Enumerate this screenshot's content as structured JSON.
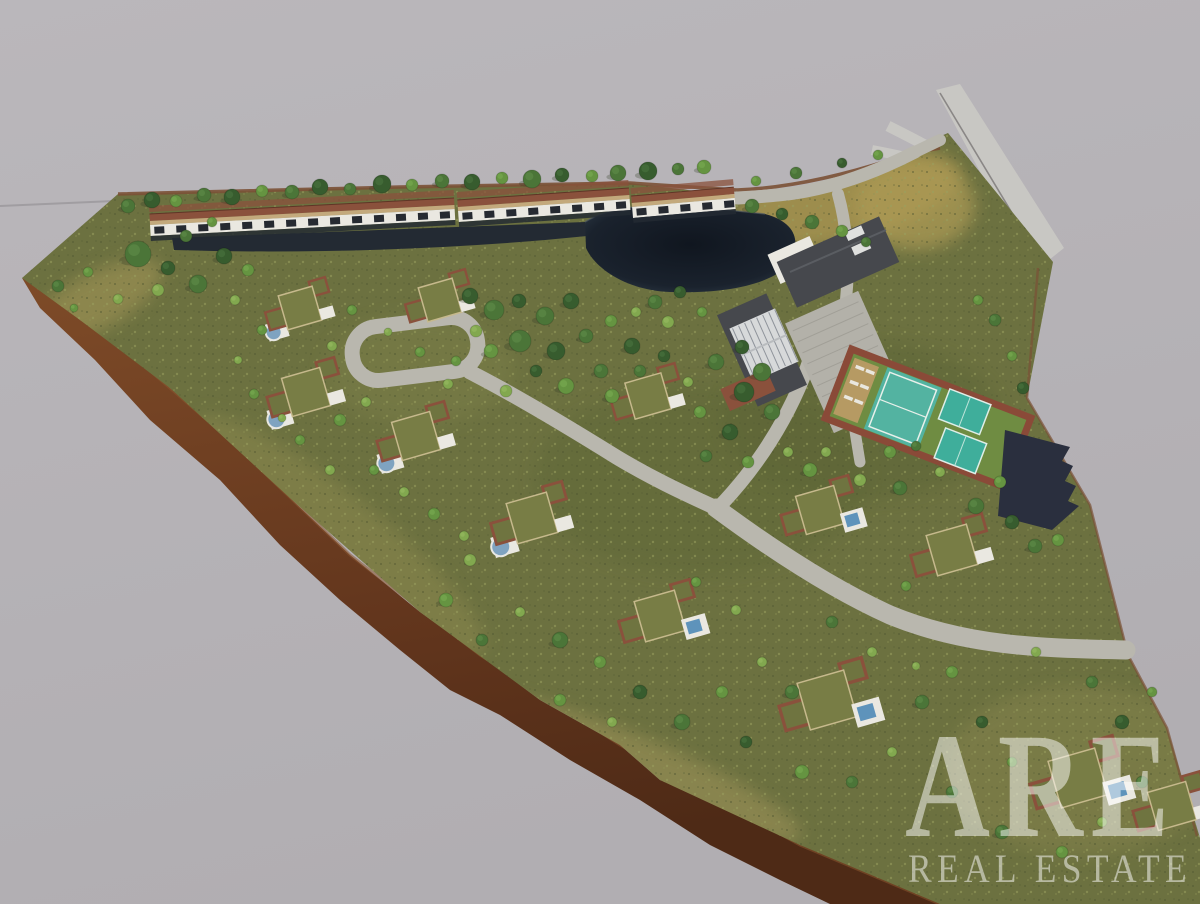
{
  "watermark": {
    "line1": "ARE",
    "line2": "REAL ESTATE",
    "color": "rgba(255,255,255,0.5)"
  },
  "colors": {
    "background": "#b7b4b8",
    "background_edge": "#b1aeb2",
    "distant_line": "#a09da1",
    "grass": "#6c7140",
    "grass_light": "#8f8a52",
    "grass_dry": "#a79a5e",
    "soil": "#6f3f22",
    "soil_dark": "#4e2a16",
    "soil_light": "#8a5530",
    "water_pond": "#141b25",
    "water_pond_edge": "#2c3844",
    "water_canal": "#232a33",
    "road": "#b9b7ae",
    "road_outside": "#c8c7c3",
    "road_edge": "#8a8786",
    "parking": "#b3b1a9",
    "parking_line": "#a19f97",
    "roof_dark": "#46484d",
    "roof_ridge": "#5a5d62",
    "roof_green": "#787d45",
    "roof_green_dark": "#6f7440",
    "wall_brick": "#8a513c",
    "wall_line": "#7b5136",
    "facade_white": "#eae8e1",
    "terrace_tan": "#c3a97c",
    "window_dark": "#262a31",
    "glass": "#d7d9da",
    "glass_line": "#8e939a",
    "pool_blue": "#7fa3c0",
    "pool_deep": "#5e93bb",
    "court_green": "#6f8c42",
    "court_teal": "#53b3a1",
    "padel_teal": "#3fae9b",
    "court_wall": "#8a4a38",
    "court_sand": "#b69a63",
    "carport_navy": "#2a2f3e",
    "tree0": "#375c2e",
    "tree1": "#4b7538",
    "tree2": "#659441",
    "tree3": "#82a84f",
    "tree_shadow": "#2e3a23",
    "roof_tan_edge": "#c6b98c"
  }
}
